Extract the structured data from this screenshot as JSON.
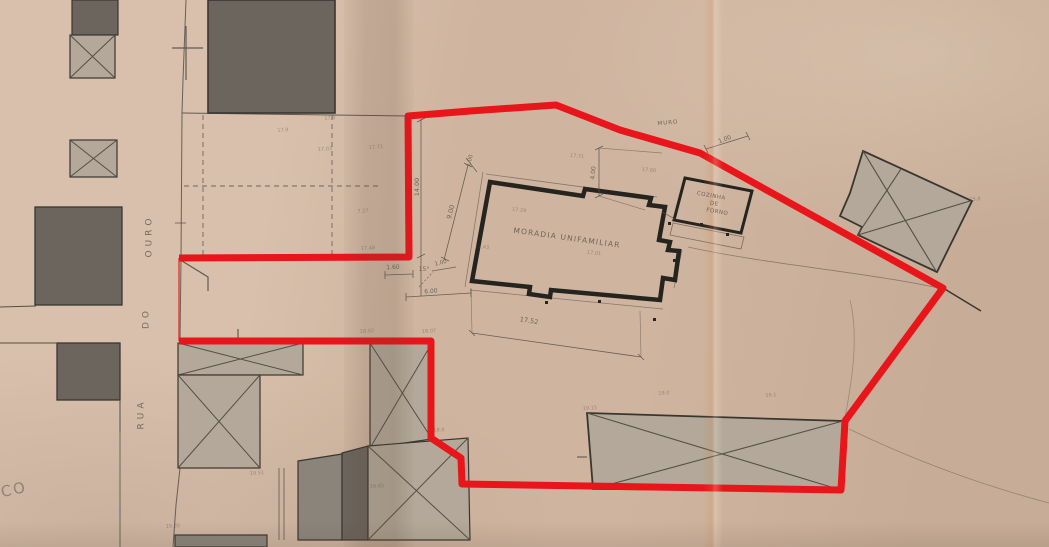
{
  "colors": {
    "paper_light": "#d8c0ac",
    "paper_mid": "#cfb5a0",
    "paper_dark": "#c7ad97",
    "boundary_red": "#e8151a",
    "wall_black": "#26241f",
    "line_dark": "#3a362f",
    "line_thin": "#554f46",
    "building_dark": "#6b655d",
    "building_mid": "#8a847b",
    "building_light": "#b3a899",
    "pencil": "#5c544a"
  },
  "annotations": [
    {
      "name": "street-name-part-ouro",
      "text": "OURO",
      "x": 150,
      "y": 236,
      "rot": -90,
      "size": 9,
      "ls": 4,
      "cls": "street"
    },
    {
      "name": "street-name-part-do",
      "text": "DO",
      "x": 147,
      "y": 318,
      "rot": -90,
      "size": 9,
      "ls": 4,
      "cls": "street"
    },
    {
      "name": "street-name-part-rua",
      "text": "RUA",
      "x": 142,
      "y": 414,
      "rot": -90,
      "size": 9,
      "ls": 4,
      "cls": "street"
    },
    {
      "name": "main-building-label",
      "text": "MORADIA UNIFAMILIAR",
      "x": 567,
      "y": 238,
      "rot": 8,
      "size": 7.5,
      "ls": 1.2
    },
    {
      "name": "outbuilding-label-line1",
      "text": "COZINHA",
      "x": 711,
      "y": 197,
      "rot": 10,
      "size": 5.5,
      "ls": 0.5
    },
    {
      "name": "outbuilding-label-line2",
      "text": "DE",
      "x": 714,
      "y": 205,
      "rot": 10,
      "size": 5.5,
      "ls": 0.5
    },
    {
      "name": "outbuilding-label-line3",
      "text": "FORNO",
      "x": 717,
      "y": 213,
      "rot": 10,
      "size": 5.5,
      "ls": 0.5
    },
    {
      "name": "wall-label",
      "text": "MURO",
      "x": 668,
      "y": 124,
      "rot": -5,
      "size": 5.5,
      "ls": 1
    },
    {
      "name": "dimension-label",
      "text": "1.00",
      "x": 725,
      "y": 140,
      "rot": -20,
      "size": 6
    },
    {
      "name": "dimension-label",
      "text": "14.00",
      "x": 417,
      "y": 187,
      "rot": -90,
      "size": 6.5
    },
    {
      "name": "dimension-label",
      "text": "9.00",
      "x": 451,
      "y": 212,
      "rot": -75,
      "size": 6.5
    },
    {
      "name": "dimension-label",
      "text": "1.00",
      "x": 471,
      "y": 161,
      "rot": -75,
      "size": 5.5
    },
    {
      "name": "dimension-label",
      "text": "1.00",
      "x": 441,
      "y": 264,
      "rot": -14,
      "size": 5.5
    },
    {
      "name": "dimension-label",
      "text": "1.60",
      "x": 393,
      "y": 268,
      "rot": -3,
      "size": 6
    },
    {
      "name": "angle-label",
      "text": "15°",
      "x": 424,
      "y": 270,
      "rot": 0,
      "size": 6
    },
    {
      "name": "dimension-label",
      "text": "6.00",
      "x": 431,
      "y": 292,
      "rot": -4,
      "size": 6
    },
    {
      "name": "dimension-label",
      "text": "17.52",
      "x": 529,
      "y": 321,
      "rot": 9,
      "size": 6.5
    },
    {
      "name": "dimension-label",
      "text": "4.00",
      "x": 594,
      "y": 173,
      "rot": -84,
      "size": 6
    },
    {
      "name": "corner-text-fragment",
      "text": "CO",
      "x": 14,
      "y": 490,
      "rot": -12,
      "size": 15,
      "cls": "corner"
    },
    {
      "name": "spot-elevation",
      "text": "17.9",
      "x": 283,
      "y": 131,
      "rot": -4,
      "size": 5,
      "cls": "faint"
    },
    {
      "name": "spot-elevation",
      "text": "17.8",
      "x": 330,
      "y": 119,
      "rot": -4,
      "size": 5,
      "cls": "faint"
    },
    {
      "name": "spot-elevation",
      "text": "17.03",
      "x": 325,
      "y": 150,
      "rot": -4,
      "size": 5,
      "cls": "faint"
    },
    {
      "name": "spot-elevation",
      "text": "17.71",
      "x": 376,
      "y": 148,
      "rot": -4,
      "size": 5,
      "cls": "faint"
    },
    {
      "name": "spot-elevation",
      "text": "7.27",
      "x": 363,
      "y": 212,
      "rot": -4,
      "size": 5,
      "cls": "faint"
    },
    {
      "name": "spot-elevation",
      "text": "17.48",
      "x": 368,
      "y": 249,
      "rot": -4,
      "size": 5,
      "cls": "faint"
    },
    {
      "name": "spot-elevation",
      "text": "17.29",
      "x": 519,
      "y": 211,
      "rot": 6,
      "size": 5,
      "cls": "faint"
    },
    {
      "name": "spot-elevation",
      "text": "17.43",
      "x": 482,
      "y": 248,
      "rot": 4,
      "size": 5,
      "cls": "faint"
    },
    {
      "name": "spot-elevation",
      "text": "17.01",
      "x": 594,
      "y": 254,
      "rot": 6,
      "size": 5,
      "cls": "faint"
    },
    {
      "name": "spot-elevation",
      "text": "17.71",
      "x": 577,
      "y": 157,
      "rot": 5,
      "size": 5,
      "cls": "faint"
    },
    {
      "name": "spot-elevation",
      "text": "17.60",
      "x": 649,
      "y": 171,
      "rot": 5,
      "size": 5,
      "cls": "faint"
    },
    {
      "name": "spot-elevation",
      "text": "18.02",
      "x": 367,
      "y": 332,
      "rot": -3,
      "size": 5,
      "cls": "faint"
    },
    {
      "name": "spot-elevation",
      "text": "18.07",
      "x": 429,
      "y": 332,
      "rot": -3,
      "size": 5,
      "cls": "faint"
    },
    {
      "name": "spot-elevation",
      "text": "18.9",
      "x": 439,
      "y": 431,
      "rot": -3,
      "size": 5,
      "cls": "faint"
    },
    {
      "name": "spot-elevation",
      "text": "19.65",
      "x": 377,
      "y": 487,
      "rot": -3,
      "size": 5,
      "cls": "faint"
    },
    {
      "name": "spot-elevation",
      "text": "19.51",
      "x": 257,
      "y": 474,
      "rot": -3,
      "size": 5,
      "cls": "faint"
    },
    {
      "name": "spot-elevation",
      "text": "19.35",
      "x": 173,
      "y": 527,
      "rot": -3,
      "size": 5,
      "cls": "faint"
    },
    {
      "name": "spot-elevation",
      "text": "19.15",
      "x": 590,
      "y": 409,
      "rot": -3,
      "size": 5,
      "cls": "faint"
    },
    {
      "name": "spot-elevation",
      "text": "19.0",
      "x": 664,
      "y": 394,
      "rot": -3,
      "size": 5,
      "cls": "faint"
    },
    {
      "name": "spot-elevation",
      "text": "19.1",
      "x": 771,
      "y": 396,
      "rot": -3,
      "size": 5,
      "cls": "faint"
    },
    {
      "name": "spot-elevation",
      "text": "15.8",
      "x": 975,
      "y": 200,
      "rot": -3,
      "size": 5,
      "cls": "faint"
    }
  ]
}
